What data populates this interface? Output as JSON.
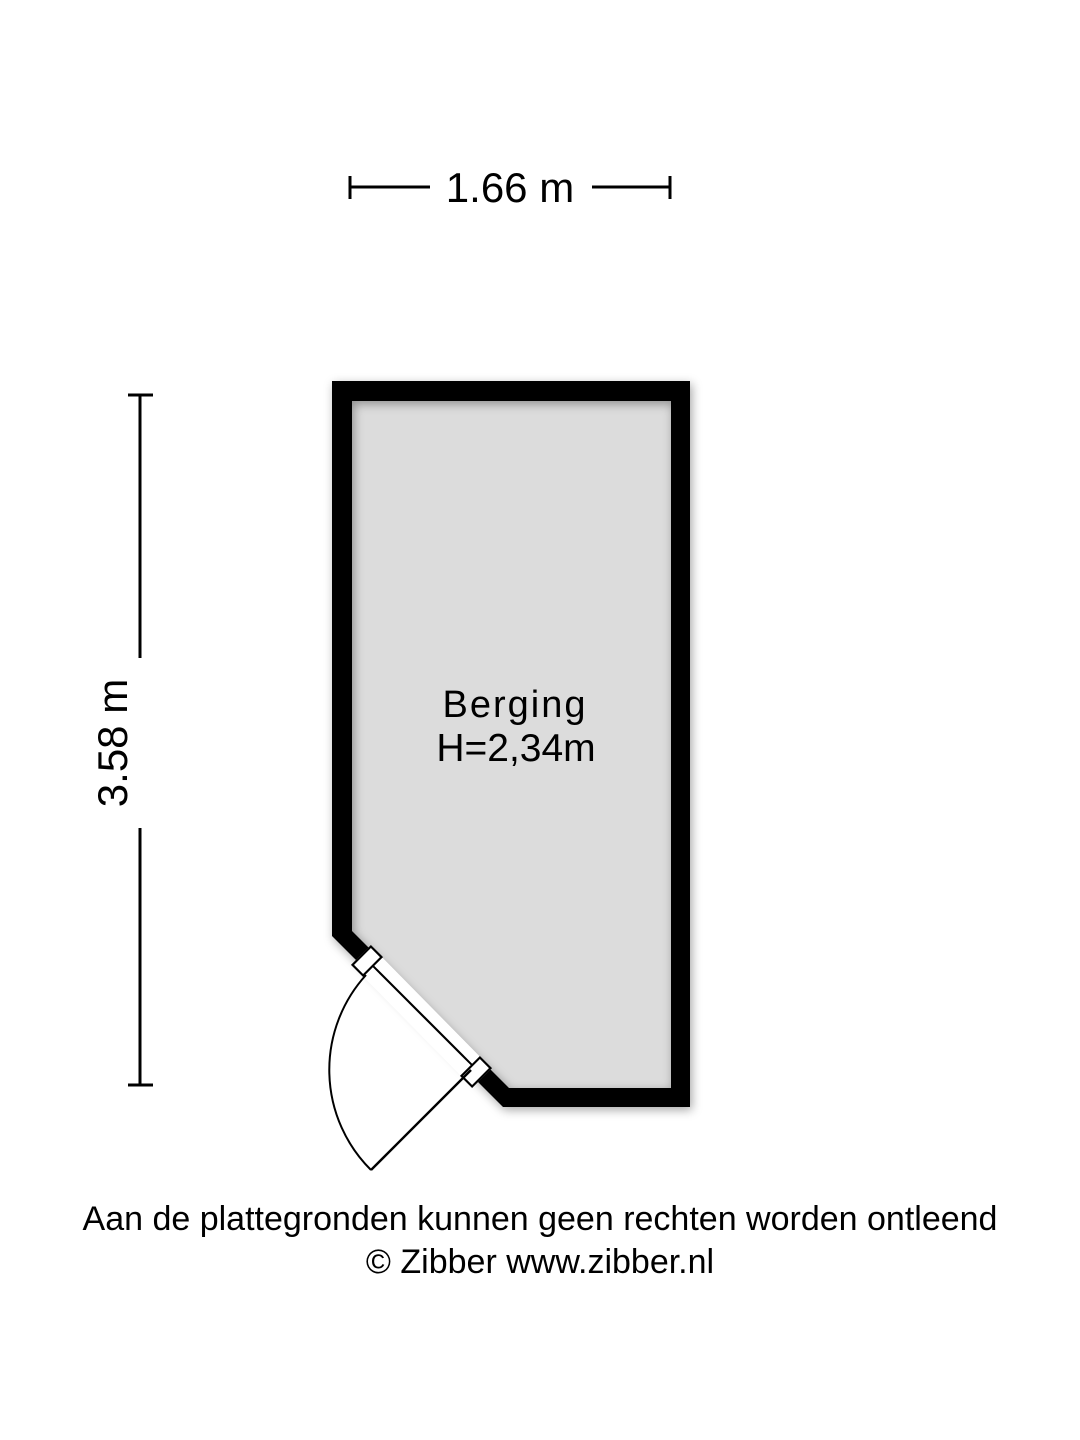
{
  "floorplan": {
    "room": {
      "name": "Berging",
      "ceiling_height_label": "H=2,34m"
    },
    "dimensions": {
      "width_label": "1.66 m",
      "depth_label": "3.58 m"
    },
    "footer": {
      "disclaimer": "Aan de plattegronden kunnen geen rechten worden ontleend",
      "copyright": "© Zibber www.zibber.nl"
    },
    "colors": {
      "wall": "#000000",
      "floor": "#dcdcdc",
      "background": "#ffffff",
      "line": "#000000"
    }
  }
}
